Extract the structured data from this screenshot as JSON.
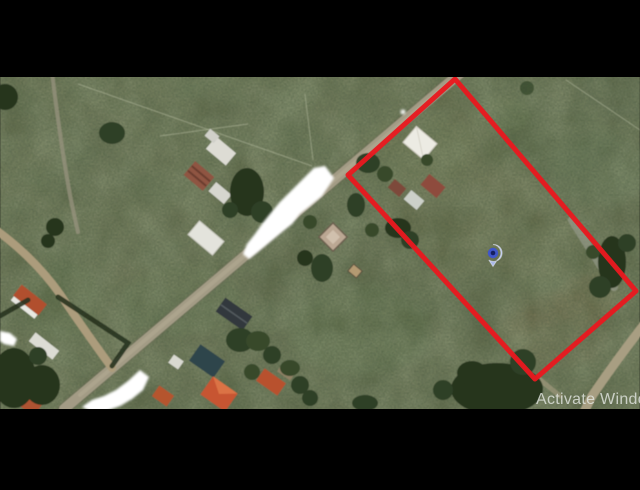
{
  "map": {
    "watermark_text": "Activate Windo",
    "watermark_color": "rgba(228,231,226,0.8)",
    "letterbox_color": "#000000",
    "terrain_base_color": "#656d4f",
    "road_color": "#a39b85",
    "parcel": {
      "points": "455,79 636,291 535,379 348,175",
      "stroke_color": "#e8191f",
      "stroke_width": "5"
    },
    "marker": {
      "transform": "translate(493,253)",
      "outer_color": "#aab9e9",
      "ring_color": "#4056c8",
      "dot_color": "#15205f"
    }
  }
}
